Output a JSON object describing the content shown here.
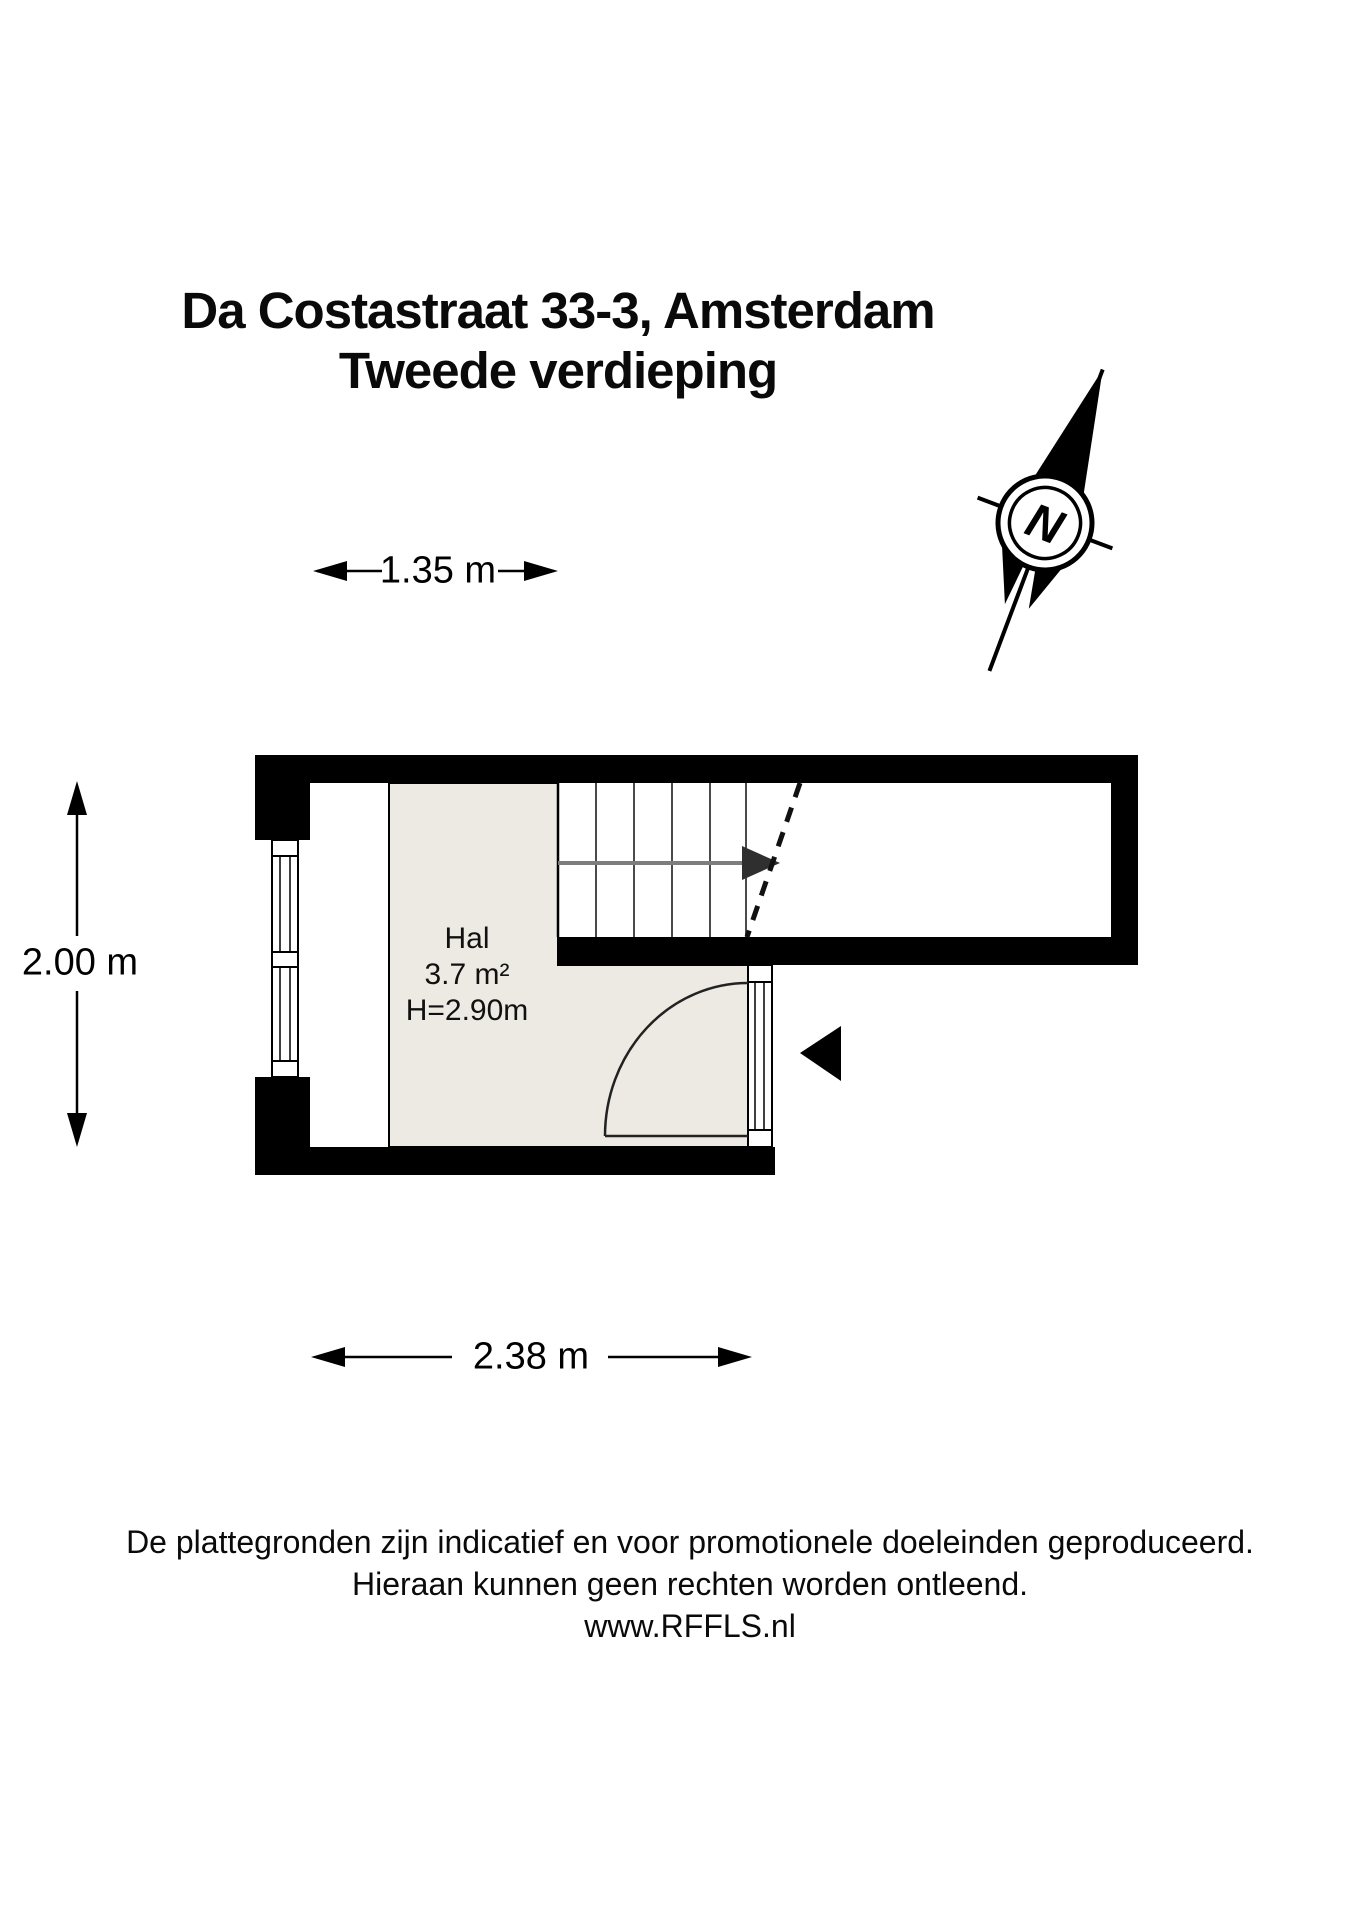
{
  "title": {
    "line1": "Da Costastraat 33-3, Amsterdam",
    "line2": "Tweede verdieping"
  },
  "compass": {
    "letter": "N"
  },
  "dimensions": {
    "top": "1.35 m",
    "left": "2.00 m",
    "bottom": "2.38 m"
  },
  "room": {
    "name": "Hal",
    "area": "3.7 m²",
    "height": "H=2.90m"
  },
  "footer": {
    "line1": "De plattegronden zijn indicatief en voor promotionele doeleinden geproduceerd.",
    "line2": "Hieraan kunnen geen rechten worden ontleend.",
    "line3": "www.RFFLS.nl"
  },
  "colors": {
    "room_fill": "#ECEAE2",
    "ink": "#000000",
    "stair_tread": "#4a4a4a",
    "stair_arrow": "#7d7d7d"
  }
}
